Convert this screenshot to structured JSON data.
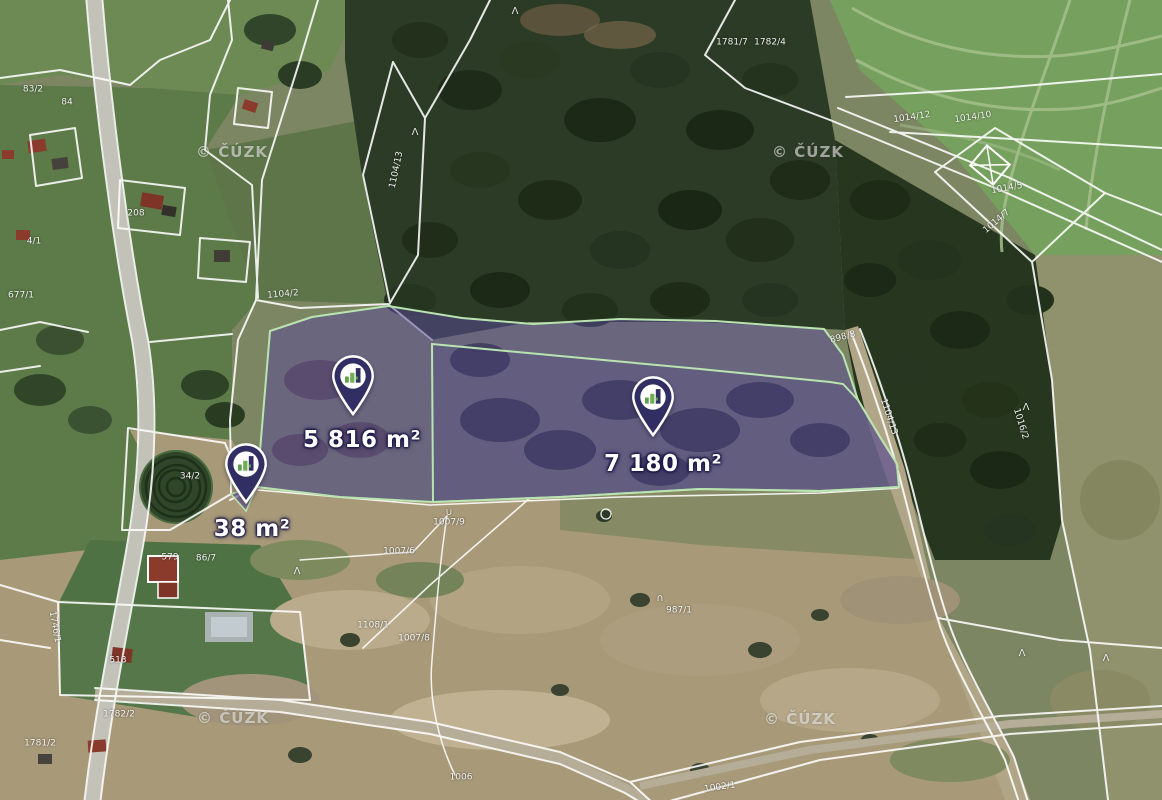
{
  "map": {
    "watermark": {
      "text": "© ČÚZK"
    },
    "watermarks": [
      {
        "x": 232,
        "y": 152
      },
      {
        "x": 808,
        "y": 152
      },
      {
        "x": 233,
        "y": 718
      },
      {
        "x": 800,
        "y": 719
      }
    ],
    "pins": [
      {
        "x": 353,
        "y": 414,
        "lx": 362,
        "ly": 428,
        "area_label": "5 816 m²"
      },
      {
        "x": 653,
        "y": 435,
        "lx": 663,
        "ly": 452,
        "area_label": "7 180 m²"
      },
      {
        "x": 246,
        "y": 502,
        "lx": 252,
        "ly": 517,
        "area_label": "38 m²"
      }
    ],
    "parcel_numbers": [
      {
        "text": "1104/13",
        "x": 397,
        "y": 170,
        "rot": -78
      },
      {
        "text": "1104/2",
        "x": 283,
        "y": 295,
        "rot": -5
      },
      {
        "text": "1781/7",
        "x": 732,
        "y": 43,
        "rot": 0
      },
      {
        "text": "1782/4",
        "x": 770,
        "y": 43,
        "rot": 0
      },
      {
        "text": "1014/12",
        "x": 912,
        "y": 118,
        "rot": -8
      },
      {
        "text": "1014/10",
        "x": 973,
        "y": 118,
        "rot": -8
      },
      {
        "text": "1014/5",
        "x": 1007,
        "y": 189,
        "rot": -10
      },
      {
        "text": "1014/7",
        "x": 997,
        "y": 222,
        "rot": -40
      },
      {
        "text": "898/8",
        "x": 843,
        "y": 338,
        "rot": -15
      },
      {
        "text": "1104/13",
        "x": 888,
        "y": 417,
        "rot": 72
      },
      {
        "text": "1016/2",
        "x": 1020,
        "y": 424,
        "rot": 73
      },
      {
        "text": "1007/9",
        "x": 449,
        "y": 523,
        "rot": 0
      },
      {
        "text": "1007/6",
        "x": 399,
        "y": 552,
        "rot": 0
      },
      {
        "text": "1108/1",
        "x": 373,
        "y": 626,
        "rot": 0
      },
      {
        "text": "1007/8",
        "x": 414,
        "y": 639,
        "rot": 0
      },
      {
        "text": "987/1",
        "x": 679,
        "y": 611,
        "rot": 0
      },
      {
        "text": "1006",
        "x": 461,
        "y": 778,
        "rot": 0
      },
      {
        "text": "1746/1",
        "x": 54,
        "y": 627,
        "rot": 80
      },
      {
        "text": "1782/2",
        "x": 119,
        "y": 715,
        "rot": 0
      },
      {
        "text": "1781/2",
        "x": 40,
        "y": 744,
        "rot": 0
      },
      {
        "text": "1002/1",
        "x": 720,
        "y": 788,
        "rot": -8
      },
      {
        "text": "579",
        "x": 170,
        "y": 558,
        "rot": 0
      },
      {
        "text": "86/7",
        "x": 206,
        "y": 559,
        "rot": 0
      },
      {
        "text": "513",
        "x": 118,
        "y": 661,
        "rot": 0
      },
      {
        "text": "34/2",
        "x": 190,
        "y": 477,
        "rot": 0
      },
      {
        "text": "208",
        "x": 136,
        "y": 214,
        "rot": 0
      },
      {
        "text": "83/2",
        "x": 33,
        "y": 90,
        "rot": 0
      },
      {
        "text": "84",
        "x": 67,
        "y": 103,
        "rot": 0
      },
      {
        "text": "4/1",
        "x": 34,
        "y": 242,
        "rot": 0
      },
      {
        "text": "677/1",
        "x": 21,
        "y": 296,
        "rot": 0
      }
    ],
    "symbols": [
      {
        "g": "Λ",
        "x": 515,
        "y": 12
      },
      {
        "g": "Λ",
        "x": 415,
        "y": 133
      },
      {
        "g": "Λ",
        "x": 1026,
        "y": 408
      },
      {
        "g": "Λ",
        "x": 1022,
        "y": 654
      },
      {
        "g": "Λ",
        "x": 297,
        "y": 572
      },
      {
        "g": "Λ",
        "x": 1106,
        "y": 659
      },
      {
        "g": "∪",
        "x": 449,
        "y": 513
      },
      {
        "g": "∩",
        "x": 660,
        "y": 599
      }
    ],
    "colors": {
      "pin_fill": "#312e63",
      "pin_logo_green": "#6fae54",
      "highlight_fill": "rgba(88,72,152,0.52)",
      "highlight_border": "#b9e4b0",
      "cadastral_line": "#ffffff"
    }
  }
}
